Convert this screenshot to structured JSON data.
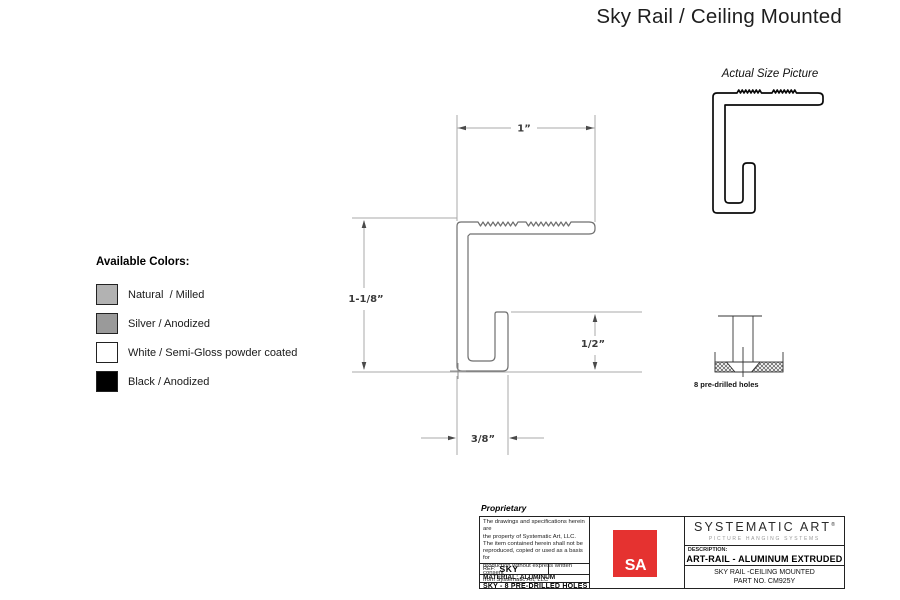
{
  "page_title": "Sky Rail / Ceiling Mounted",
  "actual_size_label": "Actual Size Picture",
  "colors": {
    "heading": "Available Colors:",
    "items": [
      {
        "label": "Natural  / Milled",
        "hex": "#b2b2b2"
      },
      {
        "label": "Silver / Anodized",
        "hex": "#9a9a9a"
      },
      {
        "label": "White / Semi-Gloss powder coated",
        "hex": "#ffffff"
      },
      {
        "label": "Black / Anodized",
        "hex": "#000000"
      }
    ]
  },
  "dimensions": {
    "top_width": "1”",
    "height": "1-1/8”",
    "hook_height": "1/2”",
    "foot_width": "3/8”"
  },
  "holes_note": "8 pre-drilled holes",
  "title_block": {
    "proprietary_heading": "Proprietary",
    "proprietary_lines": {
      "l1": "The drawings and specifications herein are",
      "l2": "the property of Systematic Art, LLC.",
      "l3": "The item contained herein shall not be",
      "l4": "reproduced, copied or used as a basis for",
      "l5": "production without express written consent",
      "l6": "from Systematic Art, LLC"
    },
    "ref_label": "REF:",
    "ref_value": "SKY",
    "material": "MATERIAL: ALUMINUM",
    "part_line": "SKY - 8 PRE-DRILLED HOLES",
    "logo_text": "SA",
    "logo_color": "#e53230",
    "company": "SYSTEMATIC ART",
    "trademark": "®",
    "tagline": "PICTURE HANGING SYSTEMS",
    "description_label": "DESCRIPTION:",
    "description": "ART-RAIL - ALUMINUM EXTRUDED",
    "product": "SKY RAIL -CEILING MOUNTED",
    "part_no": "PART NO. CM925Y"
  }
}
